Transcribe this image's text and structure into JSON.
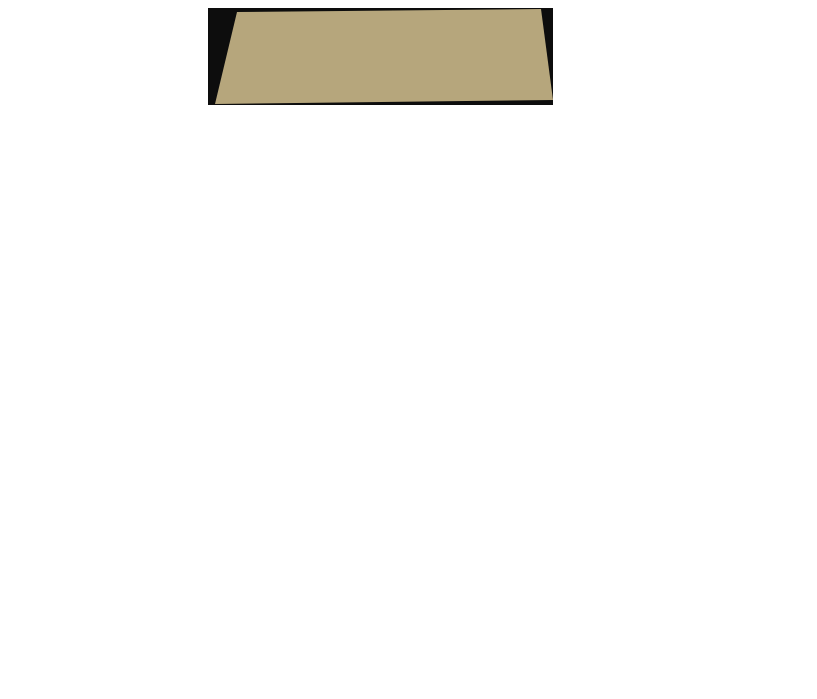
{
  "figure": {
    "sections": [
      {
        "caption": "(a) Environment-1 navigation training.",
        "env": "env1",
        "frames": [
          {
            "title": "The number of exploration episodes is 1",
            "episode": 1,
            "inset": "light",
            "robot": [
              55,
              66
            ],
            "scribbles": [
              [
                83,
                70,
                14,
                24
              ],
              [
                64,
                89,
                13,
                8
              ],
              [
                90,
                34,
                8,
                24
              ]
            ],
            "path": [
              [
                56,
                68
              ],
              [
                58,
                78
              ],
              [
                64,
                88
              ]
            ],
            "dots": [
              [
                50,
                4
              ]
            ]
          },
          {
            "title": "The number of exploration episodes is 11",
            "episode": 11,
            "inset": "light",
            "robot": [
              32,
              47
            ],
            "scribbles": [
              [
                45,
                48,
                9,
                34
              ],
              [
                39,
                83,
                13,
                12
              ],
              [
                34,
                56,
                5,
                8
              ]
            ],
            "path": [
              [
                46,
                16
              ],
              [
                58,
                12
              ],
              [
                68,
                58
              ],
              [
                64,
                64
              ],
              [
                77,
                82
              ],
              [
                93,
                78
              ],
              [
                93,
                13
              ]
            ],
            "dots": []
          },
          {
            "title": "The number of exploration episodes is 18",
            "episode": 18,
            "inset": "light",
            "robot": [
              8,
              84
            ],
            "scribbles": [],
            "path": [
              [
                7,
                85
              ],
              [
                20,
                62
              ],
              [
                29,
                42
              ],
              [
                36,
                60
              ],
              [
                44,
                30
              ],
              [
                51,
                10
              ],
              [
                62,
                28
              ],
              [
                71,
                50
              ],
              [
                69,
                60
              ],
              [
                79,
                81
              ],
              [
                91,
                77
              ],
              [
                92,
                40
              ],
              [
                90,
                13
              ]
            ],
            "dots": []
          }
        ]
      },
      {
        "caption": "(b) Environment-2 navigation training.",
        "env": "env2",
        "frames": [
          {
            "title": "The number of exploration episodes is 1",
            "episode": 1,
            "inset": "light",
            "robot": [
              57,
              6
            ],
            "scribbles": [
              [
                91,
                48,
                8,
                44
              ],
              [
                79,
                8,
                12,
                7
              ]
            ],
            "path": [
              [
                58,
                8
              ],
              [
                64,
                10
              ]
            ],
            "dots": [
              [
                44,
                92
              ]
            ]
          },
          {
            "title": "The number of exploration episodes is 14",
            "episode": 14,
            "inset": "light",
            "robot": [
              42,
              4
            ],
            "scribbles": [
              [
                43,
                30,
                8,
                14
              ],
              [
                43,
                66,
                10,
                24
              ],
              [
                45,
                8,
                5,
                6
              ]
            ],
            "path": [
              [
                48,
                45
              ],
              [
                56,
                58
              ],
              [
                66,
                62
              ],
              [
                73,
                18
              ],
              [
                92,
                84
              ]
            ],
            "dots": []
          },
          {
            "title": "The number of exploration episodes is 24",
            "episode": 24,
            "inset": "dark",
            "robot": [
              16,
              85
            ],
            "scribbles": [],
            "path": [
              [
                14,
                85
              ],
              [
                9,
                50
              ],
              [
                11,
                24
              ],
              [
                29,
                11
              ],
              [
                46,
                13
              ],
              [
                52,
                36
              ],
              [
                48,
                54
              ],
              [
                51,
                92
              ],
              [
                64,
                70
              ],
              [
                73,
                46
              ],
              [
                70,
                18
              ],
              [
                79,
                10
              ],
              [
                89,
                13
              ],
              [
                93,
                50
              ],
              [
                92,
                84
              ]
            ],
            "dots": []
          }
        ]
      },
      {
        "caption": "(c) Environment-3 navigation training.",
        "env": "env3",
        "frames": [
          {
            "title": "The number of exploration episodes is 1",
            "episode": 1,
            "inset": "light",
            "robot": [
              71,
              44
            ],
            "scribbles": [
              [
                84,
                22,
                12,
                17
              ],
              [
                88,
                74,
                9,
                16
              ]
            ],
            "path": [
              [
                72,
                46
              ],
              [
                78,
                34
              ]
            ],
            "dots": [
              [
                57,
                6
              ],
              [
                27,
                90
              ]
            ]
          },
          {
            "title": "The number of exploration episodes is 9",
            "episode": 9,
            "inset": "dark",
            "robot": [
              37,
              46
            ],
            "scribbles": [
              [
                48,
                22,
                15,
                16
              ],
              [
                45,
                48,
                7,
                12
              ]
            ],
            "path": [
              [
                60,
                16
              ],
              [
                76,
                9
              ],
              [
                88,
                22
              ],
              [
                93,
                55
              ],
              [
                93,
                76
              ]
            ],
            "dots": [
              [
                33,
                92
              ]
            ]
          },
          {
            "title": "The number of exploration episodes is 17",
            "episode": 17,
            "inset": "dark",
            "robot": [
              17,
              13
            ],
            "scribbles": [
              [
                22,
                38,
                13,
                22
              ],
              [
                27,
                74,
                9,
                16
              ]
            ],
            "path": [
              [
                33,
                80
              ],
              [
                47,
                62
              ],
              [
                52,
                40
              ],
              [
                57,
                13
              ],
              [
                76,
                9
              ],
              [
                88,
                28
              ],
              [
                92,
                53
              ],
              [
                92,
                77
              ]
            ],
            "dots": []
          },
          {
            "title": "The number of exploration episodes is 30",
            "episode": 30,
            "inset": "dark",
            "robot": [
              12,
              83
            ],
            "scribbles": [],
            "path": [
              [
                12,
                82
              ],
              [
                8,
                50
              ],
              [
                13,
                29
              ],
              [
                29,
                57
              ],
              [
                35,
                73
              ],
              [
                37,
                89
              ],
              [
                49,
                62
              ],
              [
                54,
                36
              ],
              [
                59,
                14
              ],
              [
                71,
                9
              ],
              [
                81,
                13
              ],
              [
                89,
                33
              ],
              [
                92,
                58
              ],
              [
                92,
                77
              ]
            ],
            "dots": []
          }
        ]
      }
    ]
  },
  "environments": {
    "env1": {
      "start": [
        6,
        87
      ],
      "goal": [
        89,
        12
      ],
      "walls": [
        [
          5,
          40,
          25,
          40
        ],
        [
          25,
          40,
          25,
          68
        ],
        [
          31,
          50,
          31,
          97
        ],
        [
          42,
          0,
          42,
          60
        ],
        [
          52,
          34,
          71,
          34
        ],
        [
          59,
          10,
          75,
          10
        ],
        [
          75,
          10,
          75,
          32
        ],
        [
          55,
          76,
          79,
          76
        ],
        [
          79,
          56,
          79,
          76
        ],
        [
          79,
          56,
          93,
          56
        ]
      ]
    },
    "env2": {
      "start": [
        13,
        85
      ],
      "goal": [
        92,
        86
      ],
      "walls": [
        [
          13,
          30,
          13,
          56
        ],
        [
          13,
          56,
          26,
          56
        ],
        [
          26,
          56,
          26,
          94
        ],
        [
          32,
          16,
          49,
          16
        ],
        [
          32,
          16,
          32,
          86
        ],
        [
          53,
          0,
          53,
          90
        ],
        [
          40,
          44,
          69,
          44
        ],
        [
          63,
          14,
          84,
          14
        ],
        [
          84,
          14,
          84,
          86
        ],
        [
          60,
          71,
          84,
          71
        ]
      ]
    },
    "env3": {
      "start": [
        11,
        84
      ],
      "goal": [
        92,
        79
      ],
      "walls": [
        [
          9,
          28,
          9,
          56
        ],
        [
          9,
          56,
          26,
          56
        ],
        [
          17,
          56,
          17,
          95
        ],
        [
          34,
          0,
          34,
          57
        ],
        [
          34,
          62,
          53,
          62
        ],
        [
          33,
          77,
          33,
          100
        ],
        [
          44,
          27,
          77,
          27
        ],
        [
          77,
          10,
          77,
          27
        ],
        [
          62,
          27,
          62,
          94
        ],
        [
          82,
          53,
          96,
          53
        ],
        [
          82,
          53,
          82,
          83
        ]
      ]
    }
  },
  "colors": {
    "background": "#0d0d0d",
    "frame": "#b6a67c",
    "wood": "#e3bfa5",
    "wood_streak_dark": "#d49a7e",
    "wood_streak_light": "#f6e7d7",
    "wall": "#9c9ce0",
    "wall_highlight": "#bdbdf0",
    "wall_shadow": "rgba(22,22,34,0.62)",
    "trajectory": "#ffe400",
    "start": "#e82010",
    "goal": "#17c928",
    "robot": "#151515",
    "inset_border": "#cc33cc",
    "inset_light": "#e7bcd4",
    "inset_dark": "#16091a"
  }
}
